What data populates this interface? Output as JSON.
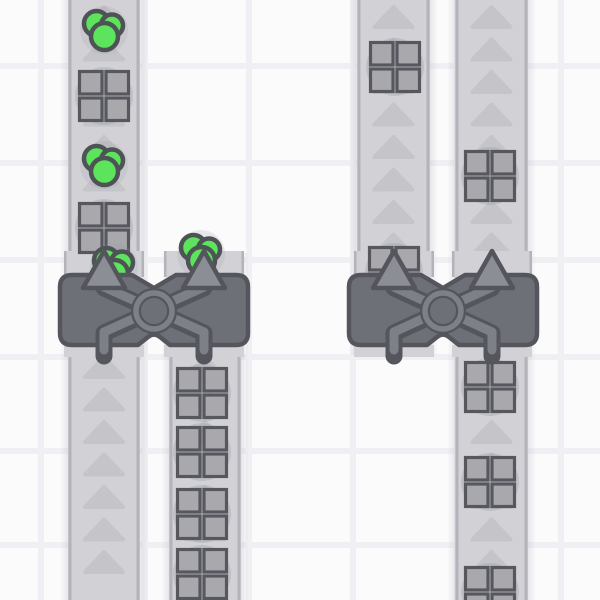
{
  "scene": {
    "canvas": {
      "width": 600,
      "height": 600
    },
    "colors": {
      "background": "#fbfbfc",
      "grid_line": "#f0f0f4",
      "belt_surface": "#d2d2d6",
      "belt_edge": "#b3b3b9",
      "belt_arrow": "#c4c4c9",
      "belt_shadow": "rgba(110,110,130,0.14)",
      "item_shadow": "rgba(150,150,165,0.30)",
      "item_shadow_light": "rgba(150,150,165,0.18)",
      "square_fill": "#a9a9ad",
      "square_stroke": "#57585e",
      "green_fill": "#5be45c",
      "green_stroke": "#4e5456",
      "machine_body": "#6e7077",
      "machine_outline": "#55565d",
      "machine_pipe": "#7e8088",
      "machine_arrow": "#8c8e95"
    },
    "grid": {
      "vlines": [
        41,
        145,
        249,
        353,
        457,
        561
      ],
      "hlines": [
        66,
        163,
        260,
        357,
        451,
        545
      ],
      "line_width": 6
    },
    "arrow_spacing": 32.5,
    "belt_arrow": {
      "half_w": 19,
      "h": 20
    },
    "belts": [
      {
        "id": "belt-a",
        "x": 68,
        "width": 72,
        "segments": [
          [
            0,
            600
          ]
        ],
        "arrow_ranges": [
          [
            7,
            255
          ],
          [
            357,
            600
          ]
        ]
      },
      {
        "id": "belt-b",
        "x": 169,
        "width": 72,
        "segments": [
          [
            253,
            600
          ]
        ],
        "arrow_ranges": [
          [
            357,
            600
          ]
        ]
      },
      {
        "id": "belt-c",
        "x": 357,
        "width": 73,
        "segments": [
          [
            0,
            355
          ]
        ],
        "arrow_ranges": [
          [
            7,
            255
          ]
        ]
      },
      {
        "id": "belt-d",
        "x": 455,
        "width": 73,
        "segments": [
          [
            0,
            600
          ]
        ],
        "arrow_ranges": [
          [
            7,
            255
          ],
          [
            357,
            600
          ]
        ]
      }
    ],
    "items": [
      {
        "type": "circle",
        "x": 104,
        "y": 30
      },
      {
        "type": "square",
        "x": 104,
        "y": 96
      },
      {
        "type": "circle",
        "x": 104,
        "y": 165
      },
      {
        "type": "square",
        "x": 104,
        "y": 228
      },
      {
        "type": "circle",
        "x": 114,
        "y": 267
      },
      {
        "type": "circle",
        "x": 201,
        "y": 254
      },
      {
        "type": "square",
        "x": 202,
        "y": 393
      },
      {
        "type": "square",
        "x": 202,
        "y": 452
      },
      {
        "type": "square",
        "x": 202,
        "y": 514
      },
      {
        "type": "square",
        "x": 202,
        "y": 574
      },
      {
        "type": "square",
        "x": 395,
        "y": 67
      },
      {
        "type": "square",
        "x": 394,
        "y": 272
      },
      {
        "type": "square",
        "x": 490,
        "y": 176
      },
      {
        "type": "square",
        "x": 490,
        "y": 387
      },
      {
        "type": "square",
        "x": 490,
        "y": 482
      },
      {
        "type": "square",
        "x": 490,
        "y": 592
      }
    ],
    "machines": [
      {
        "id": "balancer-left",
        "cx": 154,
        "tiles": [
          104,
          204
        ]
      },
      {
        "id": "balancer-right",
        "cx": 443,
        "tiles": [
          394,
          492
        ]
      }
    ],
    "machine_style": {
      "top": 275,
      "bottom": 345,
      "half_w": 94,
      "corner_r": 12,
      "notch_hw": 22,
      "notch_d": 13,
      "cy": 311,
      "circle_r": 18,
      "pipe_dark_w": 17,
      "pipe_light_w": 9,
      "arrow_tip_y": 251,
      "arrow_base_y": 288,
      "arrow_hw": 21,
      "slot_w": 80,
      "slot_top": 251,
      "slot_h": 26,
      "stub_h": 12
    },
    "item_style": {
      "square_quad": 22.5,
      "square_gap": 4,
      "square_stroke_w": 3.2,
      "square_shadow_r": 29,
      "circle_shadow_r": 24,
      "circle_stroke_w": 4.5,
      "cluster": [
        [
          -7.5,
          -6.5,
          12.5
        ],
        [
          8,
          -4.5,
          11
        ],
        [
          0.5,
          6.5,
          13.5
        ]
      ]
    }
  }
}
